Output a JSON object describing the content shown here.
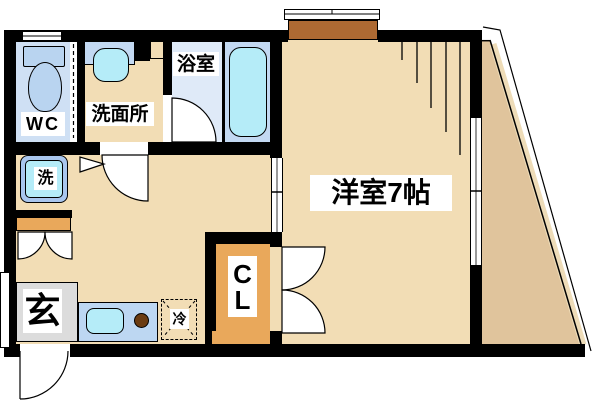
{
  "title": "apartment-floor-plan",
  "labels": {
    "wc": "WC",
    "washroom": "洗面所",
    "bathroom": "浴室",
    "washer": "洗",
    "entrance": "玄",
    "fridge": "冷",
    "closet_c": "C",
    "closet_l": "L",
    "main_room": "洋室7帖"
  },
  "colors": {
    "wall": "#000000",
    "floor": "#f2ddb5",
    "balcony": "#e0c49c",
    "balcony_edge": "#eedcb8",
    "wc_blue": "#cfe0f4",
    "fixture_blue": "#b9d4f0",
    "counter_blue": "#c3d9f2",
    "bath_blue": "#dfeaf8",
    "cyan": "#b5ecf8",
    "kitchen_blue": "#bdd7f2",
    "orange": "#e9a85b",
    "planter_brown": "#ae6a33",
    "genkan_gray": "#dcdcdc",
    "burner_brown": "#6b3c12",
    "washer_frame": "#a9c6ee"
  }
}
